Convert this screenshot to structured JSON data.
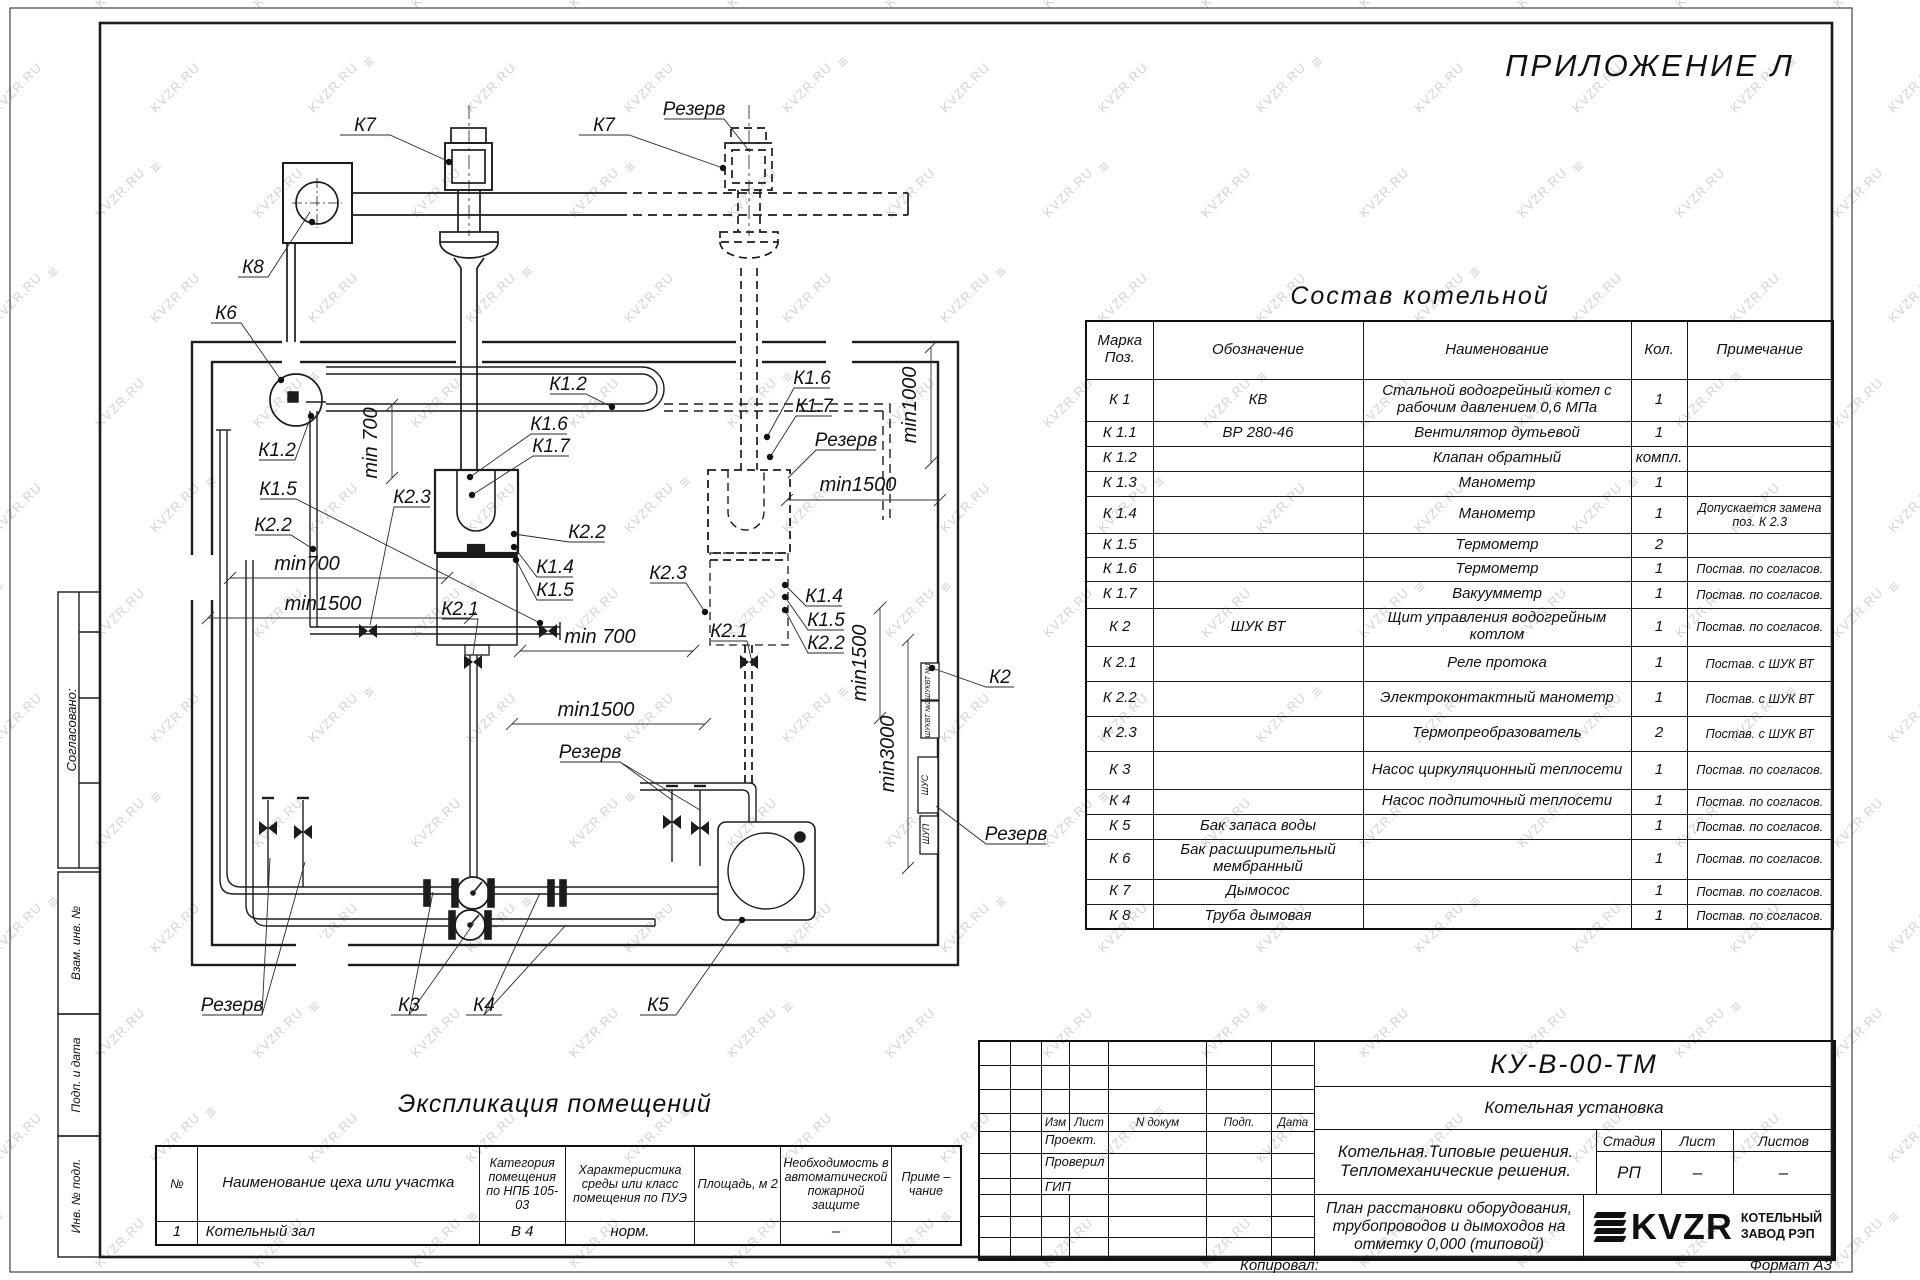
{
  "appendix": "ПРИЛОЖЕНИЕ Л",
  "watermark": {
    "text": "KVZR.RU",
    "icon": "≡"
  },
  "side_labels": {
    "agreed": "Согласовано:",
    "vzam": "Взам. инв. №",
    "podp": "Подп. и дата",
    "inv": "Инв. №  подл."
  },
  "sostav": {
    "title": "Состав котельной",
    "headers": [
      "Марка Поз.",
      "Обозначение",
      "Наименование",
      "Кол.",
      "Примечание"
    ],
    "rows": [
      [
        "К 1",
        "КВ",
        "Стальной водогрейный котел с рабочим давлением 0,6 МПа",
        "1",
        ""
      ],
      [
        "К 1.1",
        "ВР 280-46",
        "Вентилятор дутьевой",
        "1",
        ""
      ],
      [
        "К 1.2",
        "",
        "Клапан обратный",
        "компл.",
        ""
      ],
      [
        "К 1.3",
        "",
        "Манометр",
        "1",
        ""
      ],
      [
        "К 1.4",
        "",
        "Манометр",
        "1",
        "Допускается замена поз. К 2.3"
      ],
      [
        "К 1.5",
        "",
        "Термометр",
        "2",
        ""
      ],
      [
        "К 1.6",
        "",
        "Термометр",
        "1",
        "Постав. по согласов."
      ],
      [
        "К 1.7",
        "",
        "Вакуумметр",
        "1",
        "Постав. по согласов."
      ],
      [
        "К 2",
        "ШУК ВТ",
        "Щит управления водогрейным котлом",
        "1",
        "Постав. по согласов."
      ],
      [
        "К 2.1",
        "",
        "Реле протока",
        "1",
        "Постав. с ШУК ВТ"
      ],
      [
        "К 2.2",
        "",
        "Электроконтактный манометр",
        "1",
        "Постав. с ШУК ВТ"
      ],
      [
        "К 2.3",
        "",
        "Термопреобразователь",
        "2",
        "Постав. с ШУК ВТ"
      ],
      [
        "К 3",
        "",
        "Насос циркуляционный теплосети",
        "1",
        "Постав. по согласов."
      ],
      [
        "К 4",
        "",
        "Насос подпиточный теплосети",
        "1",
        "Постав. по согласов."
      ],
      [
        "К 5",
        "Бак запаса воды",
        "",
        "1",
        "Постав. по согласов."
      ],
      [
        "К 6",
        "Бак расширительный мембранный",
        "",
        "1",
        "Постав. по согласов."
      ],
      [
        "К 7",
        "Дымосос",
        "",
        "1",
        "Постав. по согласов."
      ],
      [
        "К 8",
        "Труба дымовая",
        "",
        "1",
        "Постав. по согласов."
      ]
    ]
  },
  "ekspl": {
    "title": "Экспликация помещений",
    "headers": [
      "№",
      "Наименование цеха или участка",
      "Категория помещения по НПБ 105-03",
      "Характеристика среды или класс помещения по ПУЭ",
      "Площадь, м 2",
      "Необходимость в автоматической пожарной защите",
      "Приме – чание"
    ],
    "rows": [
      [
        "1",
        "Котельный зал",
        "В 4",
        "норм.",
        "",
        "–",
        ""
      ]
    ]
  },
  "titleblock": {
    "doc_code": "КУ-В-00-ТМ",
    "object": "Котельная установка",
    "rev_cols": [
      "Изм",
      "Лист",
      "N докум",
      "Подп.",
      "Дата"
    ],
    "roles": [
      "Проект.",
      "Проверил",
      "ГИП"
    ],
    "project": [
      "Котельная.Типовые решения.",
      "Тепломеханические решения."
    ],
    "stage_headers": [
      "Стадия",
      "Лист",
      "Листов"
    ],
    "stage_values": [
      "РП",
      "–",
      "–"
    ],
    "drawing_title": [
      "План расстановки оборудования,",
      "трубопроводов и дымоходов на",
      "отметку  0,000  (типовой)"
    ],
    "logo_text": "KVZR",
    "company": [
      "КОТЕЛЬНЫЙ",
      "ЗАВОД РЭП"
    ],
    "copied": "Копировал:",
    "format": "Формат А3"
  },
  "plan": {
    "labels": [
      {
        "t": "К7",
        "x": 365,
        "y": 131
      },
      {
        "t": "К7",
        "x": 604,
        "y": 131
      },
      {
        "t": "Резерв",
        "x": 694,
        "y": 115
      },
      {
        "t": "К8",
        "x": 253,
        "y": 273
      },
      {
        "t": "К6",
        "x": 226,
        "y": 319
      },
      {
        "t": "К1.2",
        "x": 568,
        "y": 390
      },
      {
        "t": "К1.6",
        "x": 549,
        "y": 430
      },
      {
        "t": "К1.7",
        "x": 551,
        "y": 452
      },
      {
        "t": "К1.2",
        "x": 277,
        "y": 456
      },
      {
        "t": "К1.5",
        "x": 278,
        "y": 495
      },
      {
        "t": "К2.2",
        "x": 273,
        "y": 531
      },
      {
        "t": "К2.3",
        "x": 412,
        "y": 503
      },
      {
        "t": "К2.2",
        "x": 587,
        "y": 538
      },
      {
        "t": "К1.4",
        "x": 555,
        "y": 573
      },
      {
        "t": "К1.5",
        "x": 555,
        "y": 596
      },
      {
        "t": "К2.1",
        "x": 460,
        "y": 615
      },
      {
        "t": "min 700",
        "x": 377,
        "y": 443,
        "r": -90
      },
      {
        "t": "min700",
        "x": 307,
        "y": 570
      },
      {
        "t": "min1500",
        "x": 323,
        "y": 610
      },
      {
        "t": "min 700",
        "x": 600,
        "y": 643
      },
      {
        "t": "min1500",
        "x": 596,
        "y": 716
      },
      {
        "t": "К1.6",
        "x": 812,
        "y": 384
      },
      {
        "t": "К1.7",
        "x": 814,
        "y": 412
      },
      {
        "t": "Резерв",
        "x": 846,
        "y": 446
      },
      {
        "t": "min1500",
        "x": 858,
        "y": 491
      },
      {
        "t": "min1000",
        "x": 916,
        "y": 405,
        "r": -90
      },
      {
        "t": "min1500",
        "x": 866,
        "y": 663,
        "r": -90
      },
      {
        "t": "min3000",
        "x": 894,
        "y": 754,
        "r": -90
      },
      {
        "t": "К2.1",
        "x": 729,
        "y": 637
      },
      {
        "t": "К2.3",
        "x": 668,
        "y": 579
      },
      {
        "t": "К1.4",
        "x": 824,
        "y": 602
      },
      {
        "t": "К1.5",
        "x": 826,
        "y": 626
      },
      {
        "t": "К2.2",
        "x": 826,
        "y": 649
      },
      {
        "t": "К2",
        "x": 1000,
        "y": 683
      },
      {
        "t": "Резерв",
        "x": 1016,
        "y": 840
      },
      {
        "t": "Резерв",
        "x": 590,
        "y": 758
      },
      {
        "t": "Резерв",
        "x": 232,
        "y": 1011
      },
      {
        "t": "К3",
        "x": 409,
        "y": 1011
      },
      {
        "t": "К4",
        "x": 484,
        "y": 1011
      },
      {
        "t": "К5",
        "x": 658,
        "y": 1011
      },
      {
        "t": "ШУКВТ №1",
        "x": 930,
        "y": 681,
        "r": -90,
        "fs": 7
      },
      {
        "t": "ШУКВТ №2",
        "x": 930,
        "y": 719,
        "r": -90,
        "fs": 7
      },
      {
        "t": "ШУС",
        "x": 928,
        "y": 785,
        "r": -90,
        "fs": 9
      },
      {
        "t": "ШУП",
        "x": 929,
        "y": 834,
        "r": -90,
        "fs": 9
      }
    ]
  }
}
